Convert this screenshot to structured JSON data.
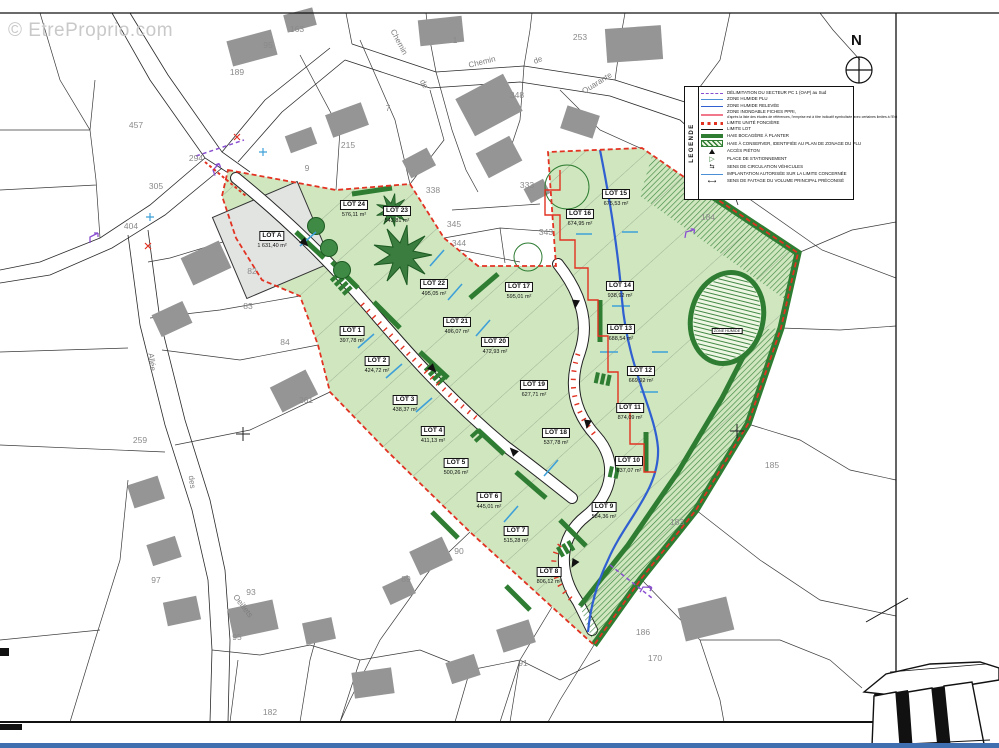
{
  "page": {
    "watermark": "© EtreProprio.com",
    "footer_color": "#3f6fae"
  },
  "compass": {
    "label": "N"
  },
  "pond": {
    "label": "ZONE HUMIDE"
  },
  "colors": {
    "lot_green": "#cfe6bf",
    "hedge_green": "#2e7d32",
    "boundary_red": "#e23222",
    "flood_blue": "#2f5fd0",
    "sector_purple": "#8a4fd0",
    "building_gray": "#959595",
    "footer_blue": "#3f6fae"
  },
  "legend": {
    "title": "LEGENDE",
    "items": [
      {
        "symbol": "sector-line",
        "label": "DÉLIMITATION DU SECTEUR PC 1 (OAP) au Sud"
      },
      {
        "symbol": "zone-humide-plu",
        "label": "ZONE HUMIDE PLU"
      },
      {
        "symbol": "zone-humide-relevee",
        "label": "ZONE HUMIDE RELEVÉE"
      },
      {
        "symbol": "zone-inondable-ppri",
        "label": "ZONE INONDABLE FICHES PPRI,",
        "sublabel": "d'après la liste des études de références, l'emprise est à titre indicatif symbolisée avec certaines limites à l'Est"
      },
      {
        "symbol": "limite-fonciere",
        "label": "LIMITE UNITÉ FONCIÈRE"
      },
      {
        "symbol": "limite-lot",
        "label": "LIMITE LOT"
      },
      {
        "symbol": "haie-a-planter",
        "label": "HAIE BOCAGÈRE À PLANTER"
      },
      {
        "symbol": "haie-a-conserver",
        "label": "HAIE À CONSERVER, IDENTIFIÉE AU PLAN DE ZONAGE DU PLU"
      },
      {
        "symbol": "acces-pieton",
        "label": "ACCÈS PIÉTON"
      },
      {
        "symbol": "place-stationnement",
        "label": "PLACE DE STATIONNEMENT"
      },
      {
        "symbol": "sens-circulation",
        "label": "SENS DE CIRCULATION VÉHICULES"
      },
      {
        "symbol": "implantation-autorisee",
        "label": "IMPLANTATION AUTORISÉE SUR LA LIMITE CONCERNÉE"
      },
      {
        "symbol": "sens-faitage",
        "label": "SENS DE FAITAGE DU VOLUME PRINCIPAL PRÉCONISÉ"
      }
    ]
  },
  "lots": [
    {
      "name": "LOT A",
      "area": "1 631,40 m²",
      "x": 272,
      "y": 232
    },
    {
      "name": "LOT 1",
      "area": "397,78 m²",
      "x": 352,
      "y": 327
    },
    {
      "name": "LOT 2",
      "area": "424,72 m²",
      "x": 377,
      "y": 357
    },
    {
      "name": "LOT 3",
      "area": "438,37 m²",
      "x": 405,
      "y": 396
    },
    {
      "name": "LOT 4",
      "area": "411,13 m²",
      "x": 433,
      "y": 427
    },
    {
      "name": "LOT 5",
      "area": "500,26 m²",
      "x": 456,
      "y": 459
    },
    {
      "name": "LOT 6",
      "area": "445,01 m²",
      "x": 489,
      "y": 493
    },
    {
      "name": "LOT 7",
      "area": "515,28 m²",
      "x": 516,
      "y": 527
    },
    {
      "name": "LOT 8",
      "area": "806,12 m²",
      "x": 549,
      "y": 568
    },
    {
      "name": "LOT 9",
      "area": "584,36 m²",
      "x": 604,
      "y": 503
    },
    {
      "name": "LOT 10",
      "area": "637,07 m²",
      "x": 629,
      "y": 457
    },
    {
      "name": "LOT 11",
      "area": "874,09 m²",
      "x": 630,
      "y": 404
    },
    {
      "name": "LOT 12",
      "area": "669,92 m²",
      "x": 641,
      "y": 367
    },
    {
      "name": "LOT 13",
      "area": "688,54 m²",
      "x": 621,
      "y": 325
    },
    {
      "name": "LOT 14",
      "area": "938,92 m²",
      "x": 620,
      "y": 282
    },
    {
      "name": "LOT 15",
      "area": "675,53 m²",
      "x": 616,
      "y": 190
    },
    {
      "name": "LOT 16",
      "area": "674,95 m²",
      "x": 580,
      "y": 210
    },
    {
      "name": "LOT 17",
      "area": "595,01 m²",
      "x": 519,
      "y": 283
    },
    {
      "name": "LOT 18",
      "area": "537,78 m²",
      "x": 556,
      "y": 429
    },
    {
      "name": "LOT 19",
      "area": "627,71 m²",
      "x": 534,
      "y": 381
    },
    {
      "name": "LOT 20",
      "area": "472,93 m²",
      "x": 495,
      "y": 338
    },
    {
      "name": "LOT 21",
      "area": "496,07 m²",
      "x": 457,
      "y": 318
    },
    {
      "name": "LOT 22",
      "area": "495,05 m²",
      "x": 434,
      "y": 280
    },
    {
      "name": "LOT 23",
      "area": "543,81 m²",
      "x": 397,
      "y": 207
    },
    {
      "name": "LOT 24",
      "area": "576,11 m²",
      "x": 354,
      "y": 201
    }
  ],
  "parcels": [
    {
      "n": "457",
      "x": 136,
      "y": 125
    },
    {
      "n": "294",
      "x": 196,
      "y": 158
    },
    {
      "n": "305",
      "x": 156,
      "y": 186
    },
    {
      "n": "404",
      "x": 131,
      "y": 226
    },
    {
      "n": "189",
      "x": 237,
      "y": 72
    },
    {
      "n": "95",
      "x": 268,
      "y": 45
    },
    {
      "n": "163",
      "x": 297,
      "y": 29
    },
    {
      "n": "1",
      "x": 455,
      "y": 40
    },
    {
      "n": "7",
      "x": 388,
      "y": 108
    },
    {
      "n": "215",
      "x": 348,
      "y": 145
    },
    {
      "n": "9",
      "x": 307,
      "y": 168
    },
    {
      "n": "338",
      "x": 433,
      "y": 190
    },
    {
      "n": "348",
      "x": 517,
      "y": 95
    },
    {
      "n": "253",
      "x": 580,
      "y": 37
    },
    {
      "n": "333",
      "x": 527,
      "y": 185
    },
    {
      "n": "345",
      "x": 454,
      "y": 224
    },
    {
      "n": "344",
      "x": 459,
      "y": 243
    },
    {
      "n": "343",
      "x": 546,
      "y": 232
    },
    {
      "n": "184",
      "x": 708,
      "y": 217
    },
    {
      "n": "185",
      "x": 772,
      "y": 465
    },
    {
      "n": "183",
      "x": 677,
      "y": 522
    },
    {
      "n": "186",
      "x": 643,
      "y": 632
    },
    {
      "n": "170",
      "x": 655,
      "y": 658
    },
    {
      "n": "91",
      "x": 523,
      "y": 663
    },
    {
      "n": "90",
      "x": 459,
      "y": 551
    },
    {
      "n": "89",
      "x": 406,
      "y": 579
    },
    {
      "n": "84",
      "x": 285,
      "y": 342
    },
    {
      "n": "83",
      "x": 248,
      "y": 306
    },
    {
      "n": "82",
      "x": 252,
      "y": 271
    },
    {
      "n": "259",
      "x": 140,
      "y": 440
    },
    {
      "n": "261",
      "x": 306,
      "y": 400
    },
    {
      "n": "97",
      "x": 156,
      "y": 580
    },
    {
      "n": "93",
      "x": 251,
      "y": 592
    },
    {
      "n": "95",
      "x": 237,
      "y": 637
    },
    {
      "n": "182",
      "x": 270,
      "y": 712
    }
  ],
  "streets": [
    {
      "name": "Chemin",
      "x": 399,
      "y": 42,
      "rot": 62
    },
    {
      "name": "de",
      "x": 424,
      "y": 84,
      "rot": 62
    },
    {
      "name": "Chemin",
      "x": 482,
      "y": 62,
      "rot": -14
    },
    {
      "name": "de",
      "x": 538,
      "y": 60,
      "rot": -22
    },
    {
      "name": "Quarante",
      "x": 597,
      "y": 83,
      "rot": -32
    },
    {
      "name": "Puits",
      "x": 716,
      "y": 172,
      "rot": 80
    },
    {
      "name": "Allée",
      "x": 152,
      "y": 362,
      "rot": 83
    },
    {
      "name": "des",
      "x": 192,
      "y": 482,
      "rot": 83
    },
    {
      "name": "Oeillets",
      "x": 243,
      "y": 606,
      "rot": 52
    }
  ]
}
